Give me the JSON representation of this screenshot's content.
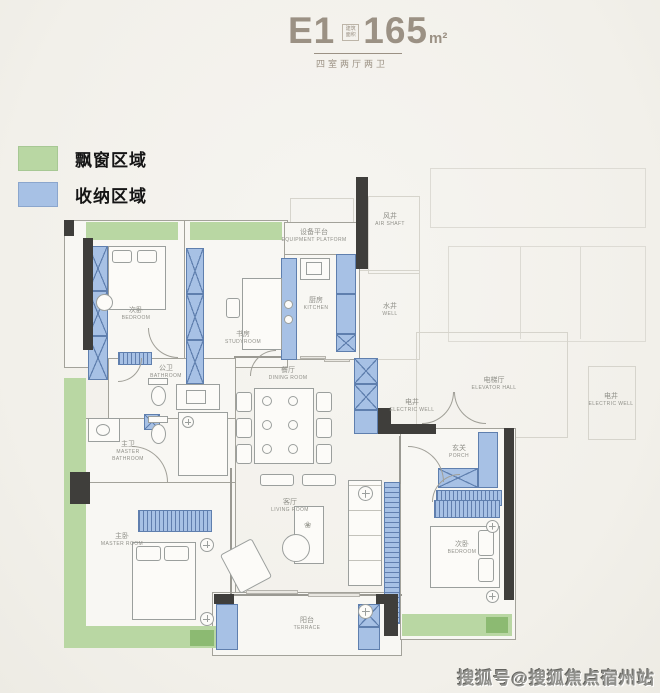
{
  "header": {
    "plan_code": "E1",
    "area_prefix": "建筑面积",
    "area_value": "165",
    "area_unit": "m²",
    "subtitle": "四室两厅两卫"
  },
  "legend": {
    "bay_window": "飘窗区域",
    "storage": "收纳区域"
  },
  "rooms": {
    "bedroom_top_left": {
      "zh": "次卧",
      "en": "BEDROOM"
    },
    "study": {
      "zh": "书房",
      "en": "STUDYROOM"
    },
    "equipment_platform": {
      "zh": "设备平台",
      "en": "EQUIPMENT PLATFORM"
    },
    "air_shaft": {
      "zh": "风井",
      "en": "AIR SHAFT"
    },
    "kitchen": {
      "zh": "厨房",
      "en": "KITCHEN"
    },
    "water_well": {
      "zh": "水井",
      "en": "WELL"
    },
    "bathroom": {
      "zh": "公卫",
      "en": "BATHROOM"
    },
    "master_bathroom": {
      "zh": "主卫",
      "en": "MASTER BATHROOM"
    },
    "dining_room": {
      "zh": "餐厅",
      "en": "DINING ROOM"
    },
    "elevator_hall": {
      "zh": "电梯厅",
      "en": "ELEVATOR HALL"
    },
    "electric_well_inner": {
      "zh": "电井",
      "en": "ELECTRIC WELL"
    },
    "electric_well_right": {
      "zh": "电井",
      "en": "ELECTRIC WELL"
    },
    "porch": {
      "zh": "玄关",
      "en": "PORCH"
    },
    "master_room": {
      "zh": "主卧",
      "en": "MASTER ROOM"
    },
    "living_room": {
      "zh": "客厅",
      "en": "LIVING ROOM"
    },
    "bedroom_bottom_right": {
      "zh": "次卧",
      "en": "BEDROOM"
    },
    "terrace": {
      "zh": "阳台",
      "en": "TERRACE"
    }
  },
  "watermark": "搜狐号@搜狐焦点宿州站",
  "colors": {
    "bay_window": "#b9d7a3",
    "bay_window_dark": "#8cba72",
    "storage": "#a7c1e5",
    "storage_line": "#5f7fae",
    "wall_dark": "#3f3e3b",
    "accent_text": "#9b9184"
  }
}
